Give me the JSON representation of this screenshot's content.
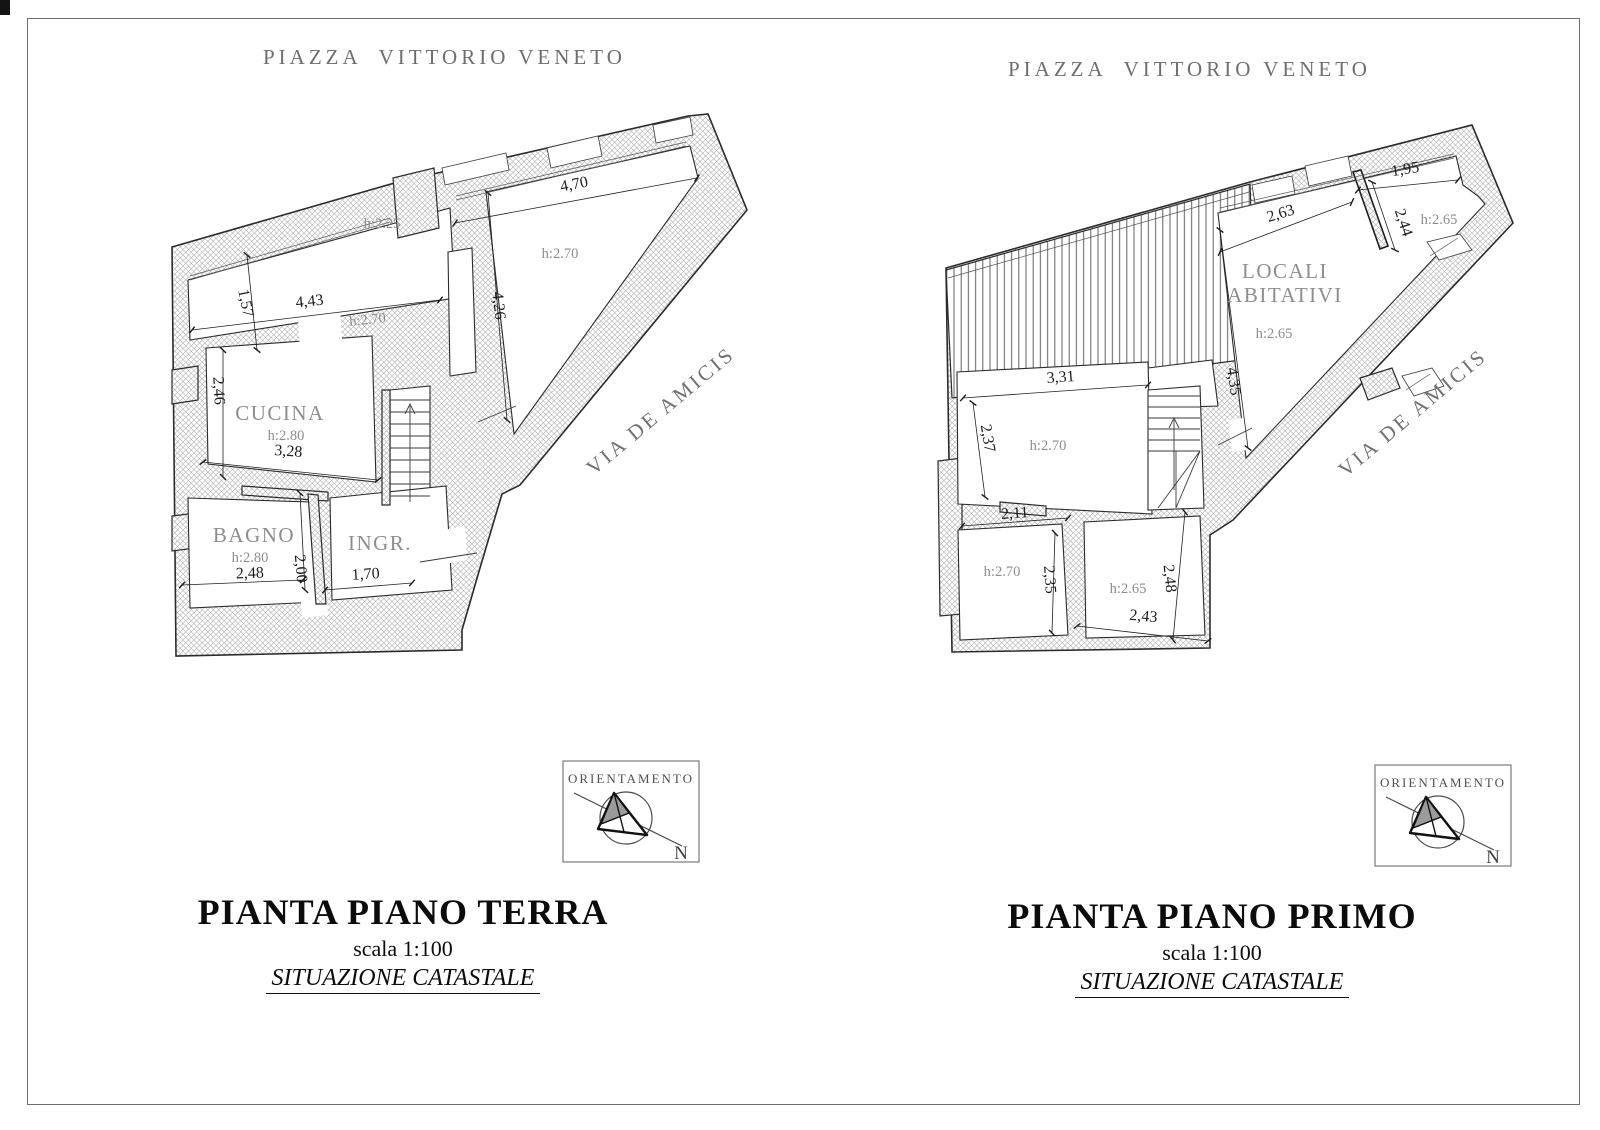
{
  "streets": {
    "piazza_terra": "PIAZZA  VITTORIO VENETO",
    "piazza_primo": "PIAZZA  VITTORIO VENETO",
    "via_terra": "VIA DE AMICIS",
    "via_primo": "VIA DE AMICIS"
  },
  "terra": {
    "title": "PIANTA PIANO TERRA",
    "scale": "scala 1:100",
    "subtitle": "SITUAZIONE CATASTALE",
    "labels": {
      "h225": "h:2.25",
      "h270_room": "h:2.70",
      "h270_tri": "h:2.70",
      "d443": "4,43",
      "d157": "1,57",
      "d470": "4,70",
      "d426": "4,26",
      "d246": "2,46",
      "d328": "3,28",
      "d248": "2,48",
      "d200": "2,00",
      "d170": "1,70",
      "cucina": "CUCINA",
      "cucina_h": "h:2.80",
      "bagno": "BAGNO",
      "bagno_h": "h:2.80",
      "ingr": "INGR."
    }
  },
  "primo": {
    "title": "PIANTA PIANO PRIMO",
    "scale": "scala 1:100",
    "subtitle": "SITUAZIONE CATASTALE",
    "labels": {
      "d263": "2,63",
      "d195": "1,95",
      "d244": "2,44",
      "h265_tr": "h:2.65",
      "locali_1": "LOCALI",
      "locali_2": "ABITATIVI",
      "locali_h": "h:2.65",
      "d435": "4,35",
      "d331": "3,31",
      "d237": "2,37",
      "h270_main": "h:2.70",
      "d211": "2,11",
      "h270_small": "h:2.70",
      "d235": "2,35",
      "h265_mid": "h:2.65",
      "d248": "2,48",
      "d243": "2,43"
    }
  },
  "compass": {
    "label": "ORIENTAMENTO",
    "north": "N"
  }
}
